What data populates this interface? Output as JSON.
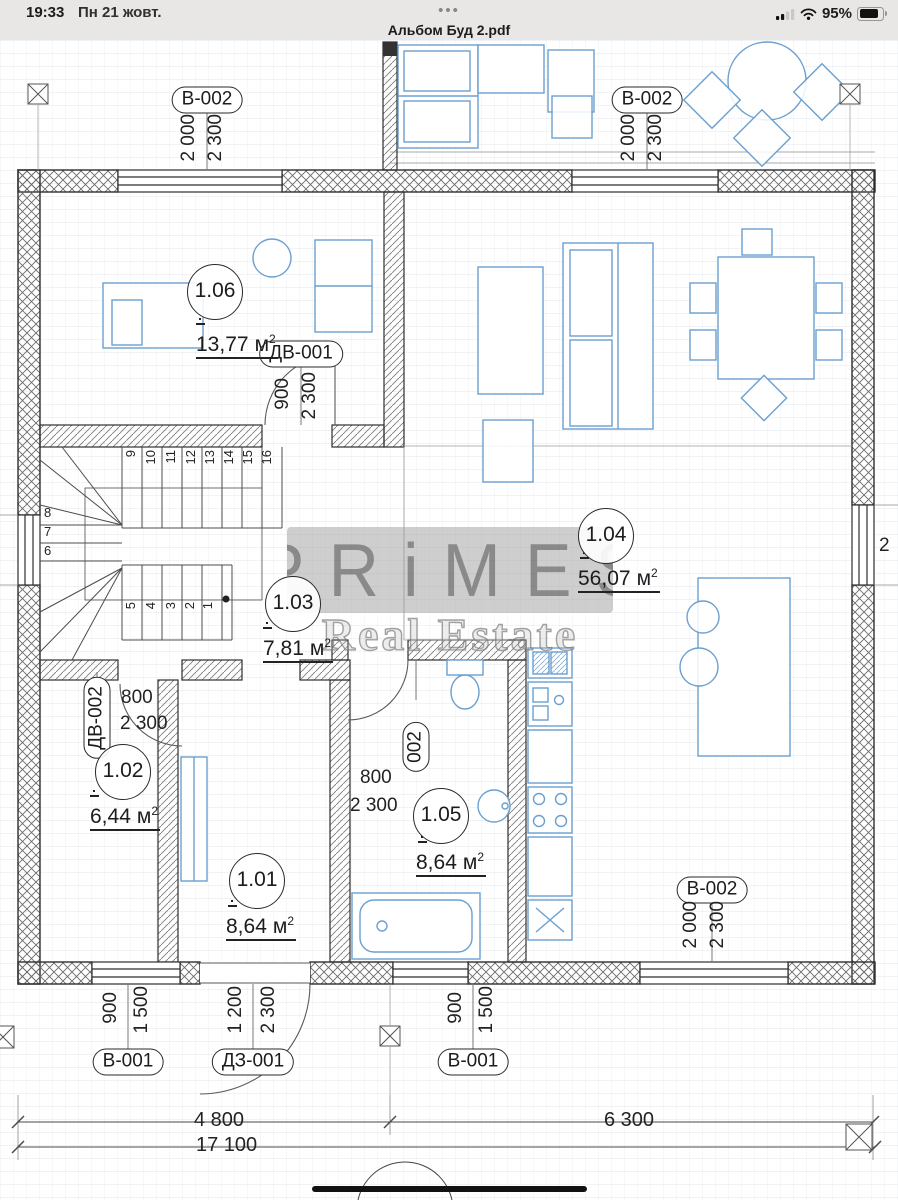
{
  "status_bar": {
    "time": "19:33",
    "date": "Пн 21 жовт.",
    "battery_percent": "95%"
  },
  "header": {
    "menu_dots": "•••",
    "title": "Альбом Буд 2.pdf"
  },
  "watermark": {
    "brand": "PRiMES",
    "subtitle": "Real Estate"
  },
  "rooms": {
    "r101": {
      "id": "1.01",
      "area": "8,64",
      "unit": "м",
      "sup": "2"
    },
    "r102": {
      "id": "1.02",
      "area": "6,44",
      "unit": "м",
      "sup": "2"
    },
    "r103": {
      "id": "1.03",
      "area": "7,81",
      "unit": "м",
      "sup": "2"
    },
    "r104": {
      "id": "1.04",
      "area": "56,07",
      "unit": "м",
      "sup": "2"
    },
    "r105": {
      "id": "1.05",
      "area": "8,64",
      "unit": "м",
      "sup": "2"
    },
    "r106": {
      "id": "1.06",
      "area": "13,77",
      "unit": "м",
      "sup": "2"
    }
  },
  "tags": {
    "window_top_left": "В-002",
    "window_top_right": "В-002",
    "window_bottom_right": "В-002",
    "door_room106": "ДВ-001",
    "door_room102": "ДВ-002",
    "door_room105": "002",
    "window_bottom_left": "В-001",
    "window_bottom_mid": "В-001",
    "entrance_door": "ДЗ-001"
  },
  "dims": {
    "top_left": [
      "2 000",
      "2 300"
    ],
    "top_right": [
      "2 000",
      "2 300"
    ],
    "bottom_right": [
      "2 000",
      "2 300"
    ],
    "door_106": [
      "900",
      "2 300"
    ],
    "door_102": [
      "800",
      "2 300"
    ],
    "door_105": [
      "800",
      "2 300"
    ],
    "window_bl": [
      "900",
      "1 500"
    ],
    "window_bm": [
      "900",
      "1 500"
    ],
    "entrance": [
      "1 200",
      "2 300"
    ],
    "right_edge_partial": "2"
  },
  "totals": {
    "span_left": "4 800",
    "span_right": "6 300",
    "overall": "17 100"
  },
  "stairs": {
    "n": [
      "1",
      "2",
      "3",
      "4",
      "5",
      "6",
      "7",
      "8",
      "9",
      "10",
      "11",
      "12",
      "13",
      "14",
      "15",
      "16"
    ]
  }
}
